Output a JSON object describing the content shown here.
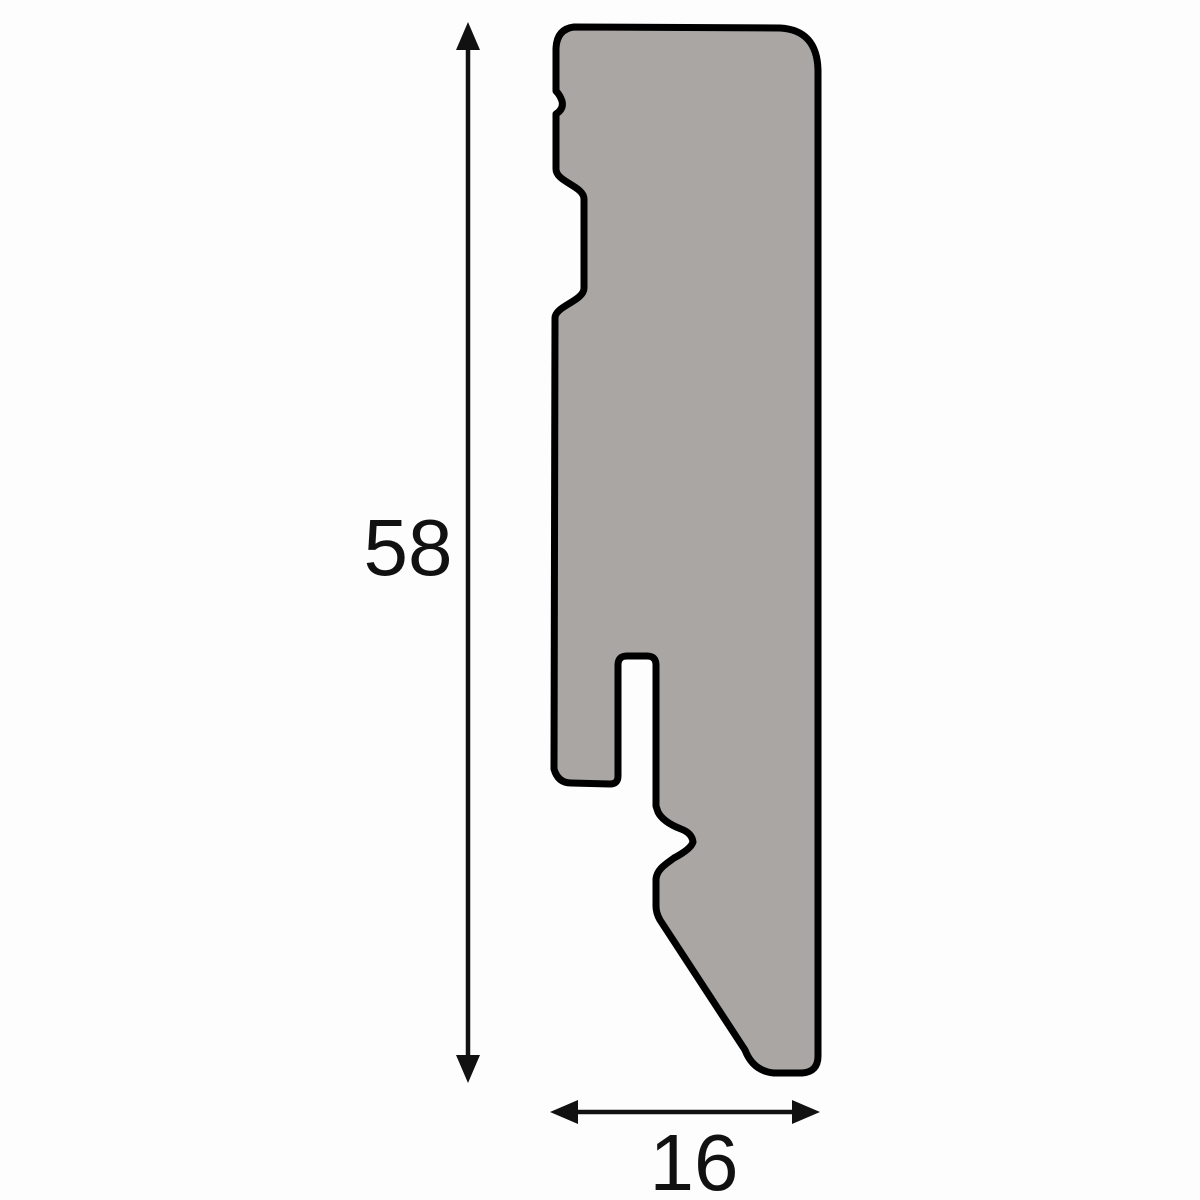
{
  "diagram": {
    "type": "profile-cross-section",
    "height_dimension": {
      "label": "58"
    },
    "width_dimension": {
      "label": "16"
    }
  },
  "colors": {
    "background": "#fdfdfd",
    "profile_fill": "#aaa6a4",
    "outline": "#000000",
    "dimension_color": "#111111"
  }
}
